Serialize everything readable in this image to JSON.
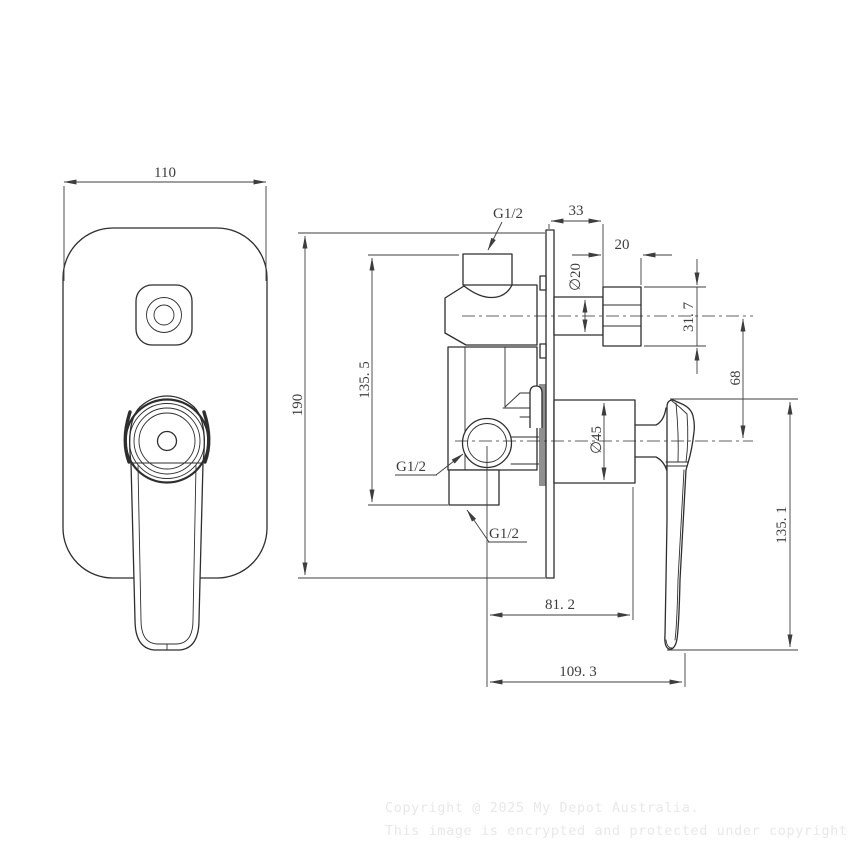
{
  "colors": {
    "line": "#2e2e2e",
    "dim": "#3d3d3d",
    "watermark": "#e8e8e8",
    "gasket": "#8f8f8f"
  },
  "views": {
    "front": {
      "width": "110",
      "height": "190"
    },
    "side": {
      "body_height": "135. 5",
      "plate_to_spout": "33",
      "spout_length": "20",
      "spout_diameter": "∅20",
      "spout_height": "31. 7",
      "port_spacing": "68",
      "cartridge_diameter": "∅45",
      "inlet_to_cartridge": "81. 2",
      "inlet_to_handle": "109. 3",
      "handle_length": "135. 1",
      "thread_top": "G1/2",
      "thread_inlet": "G1/2",
      "thread_bottom": "G1/2"
    }
  },
  "footer": {
    "line1": "Copyright @ 2025 My Depot Australia.",
    "line2": "This image is encrypted and protected under copyright law."
  }
}
